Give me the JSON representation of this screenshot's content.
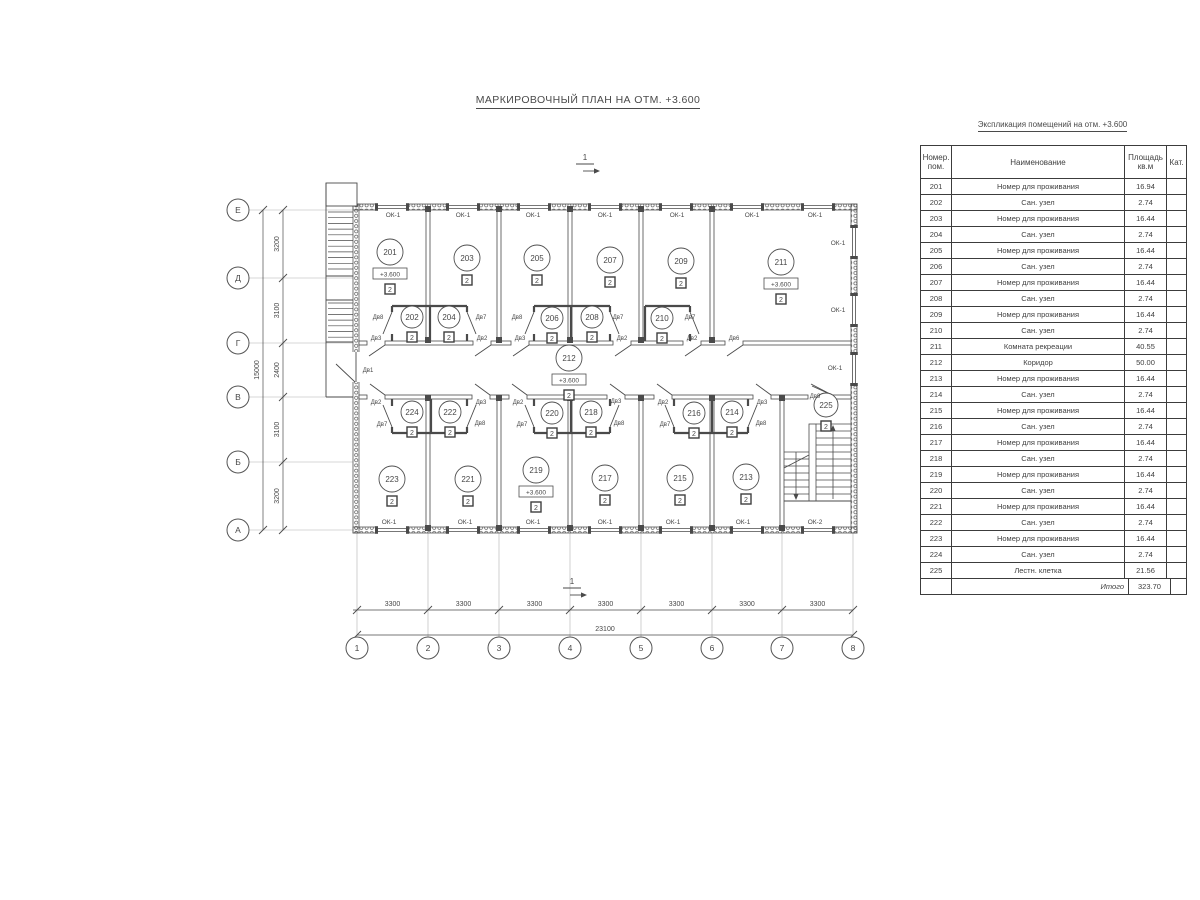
{
  "page_title": "МАРКИРОВОЧНЫЙ ПЛАН НА ОТМ. +3.600",
  "schedule": {
    "title": "Экспликация помещений на отм. +3.600",
    "headers": {
      "num": "Номер.\nпом.",
      "name": "Наименование",
      "area": "Площадь\nкв.м",
      "cat": "Кат."
    },
    "rows": [
      {
        "num": "201",
        "name": "Номер для проживания",
        "area": "16.94"
      },
      {
        "num": "202",
        "name": "Сан. узел",
        "area": "2.74"
      },
      {
        "num": "203",
        "name": "Номер для проживания",
        "area": "16.44"
      },
      {
        "num": "204",
        "name": "Сан. узел",
        "area": "2.74"
      },
      {
        "num": "205",
        "name": "Номер для проживания",
        "area": "16.44"
      },
      {
        "num": "206",
        "name": "Сан. узел",
        "area": "2.74"
      },
      {
        "num": "207",
        "name": "Номер для проживания",
        "area": "16.44"
      },
      {
        "num": "208",
        "name": "Сан. узел",
        "area": "2.74"
      },
      {
        "num": "209",
        "name": "Номер для проживания",
        "area": "16.44"
      },
      {
        "num": "210",
        "name": "Сан. узел",
        "area": "2.74"
      },
      {
        "num": "211",
        "name": "Комната рекреации",
        "area": "40.55"
      },
      {
        "num": "212",
        "name": "Коридор",
        "area": "50.00"
      },
      {
        "num": "213",
        "name": "Номер для проживания",
        "area": "16.44"
      },
      {
        "num": "214",
        "name": "Сан. узел",
        "area": "2.74"
      },
      {
        "num": "215",
        "name": "Номер для проживания",
        "area": "16.44"
      },
      {
        "num": "216",
        "name": "Сан. узел",
        "area": "2.74"
      },
      {
        "num": "217",
        "name": "Номер для проживания",
        "area": "16.44"
      },
      {
        "num": "218",
        "name": "Сан. узел",
        "area": "2.74"
      },
      {
        "num": "219",
        "name": "Номер для проживания",
        "area": "16.44"
      },
      {
        "num": "220",
        "name": "Сан. узел",
        "area": "2.74"
      },
      {
        "num": "221",
        "name": "Номер для проживания",
        "area": "16.44"
      },
      {
        "num": "222",
        "name": "Сан. узел",
        "area": "2.74"
      },
      {
        "num": "223",
        "name": "Номер для проживания",
        "area": "16.44"
      },
      {
        "num": "224",
        "name": "Сан. узел",
        "area": "2.74"
      },
      {
        "num": "225",
        "name": "Лестн. клетка",
        "area": "21.56"
      }
    ],
    "total_label": "Итого",
    "total_area": "323.70"
  },
  "plan": {
    "grid_cols": [
      {
        "label": "1",
        "x": 357
      },
      {
        "label": "2",
        "x": 428
      },
      {
        "label": "3",
        "x": 499
      },
      {
        "label": "4",
        "x": 570
      },
      {
        "label": "5",
        "x": 641
      },
      {
        "label": "6",
        "x": 712
      },
      {
        "label": "7",
        "x": 782
      },
      {
        "label": "8",
        "x": 853
      }
    ],
    "grid_rows": [
      {
        "label": "Е",
        "y": 210
      },
      {
        "label": "Д",
        "y": 278
      },
      {
        "label": "Г",
        "y": 343
      },
      {
        "label": "В",
        "y": 397
      },
      {
        "label": "Б",
        "y": 462
      },
      {
        "label": "А",
        "y": 530
      }
    ],
    "left_dims": {
      "segments": [
        "3200",
        "3100",
        "2400",
        "3100",
        "3200"
      ],
      "total": "15000"
    },
    "bottom_dims": {
      "segments": [
        "3300",
        "3300",
        "3300",
        "3300",
        "3300",
        "3300",
        "3300"
      ],
      "total": "23100"
    },
    "section_marks": [
      {
        "text": "1",
        "x": 585,
        "y": 160
      },
      {
        "text": "1",
        "x": 572,
        "y": 584
      }
    ],
    "level_mark": "+3.600",
    "category_mark": "2",
    "rooms": [
      {
        "id": "201",
        "x": 390,
        "y": 252,
        "r": 13,
        "level": true
      },
      {
        "id": "203",
        "x": 467,
        "y": 258,
        "r": 13
      },
      {
        "id": "205",
        "x": 537,
        "y": 258,
        "r": 13
      },
      {
        "id": "207",
        "x": 610,
        "y": 260,
        "r": 13
      },
      {
        "id": "209",
        "x": 681,
        "y": 261,
        "r": 13
      },
      {
        "id": "211",
        "x": 781,
        "y": 262,
        "r": 13,
        "level": true
      },
      {
        "id": "202",
        "x": 412,
        "y": 317,
        "r": 11
      },
      {
        "id": "204",
        "x": 449,
        "y": 317,
        "r": 11
      },
      {
        "id": "206",
        "x": 552,
        "y": 318,
        "r": 11
      },
      {
        "id": "208",
        "x": 592,
        "y": 317,
        "r": 11
      },
      {
        "id": "210",
        "x": 662,
        "y": 318,
        "r": 11
      },
      {
        "id": "212",
        "x": 569,
        "y": 358,
        "r": 13,
        "level": true
      },
      {
        "id": "224",
        "x": 412,
        "y": 412,
        "r": 11
      },
      {
        "id": "222",
        "x": 450,
        "y": 412,
        "r": 11
      },
      {
        "id": "220",
        "x": 552,
        "y": 413,
        "r": 11
      },
      {
        "id": "218",
        "x": 591,
        "y": 412,
        "r": 11
      },
      {
        "id": "216",
        "x": 694,
        "y": 413,
        "r": 11
      },
      {
        "id": "214",
        "x": 732,
        "y": 412,
        "r": 11
      },
      {
        "id": "223",
        "x": 392,
        "y": 479,
        "r": 13
      },
      {
        "id": "221",
        "x": 468,
        "y": 479,
        "r": 13
      },
      {
        "id": "219",
        "x": 536,
        "y": 470,
        "r": 13,
        "level": true
      },
      {
        "id": "217",
        "x": 605,
        "y": 478,
        "r": 13
      },
      {
        "id": "215",
        "x": 680,
        "y": 478,
        "r": 13
      },
      {
        "id": "213",
        "x": 746,
        "y": 477,
        "r": 13
      },
      {
        "id": "225",
        "x": 826,
        "y": 405,
        "r": 12
      }
    ],
    "window_labels": [
      {
        "text": "ОК-1",
        "x": 393,
        "y": 217
      },
      {
        "text": "ОК-1",
        "x": 463,
        "y": 217
      },
      {
        "text": "ОК-1",
        "x": 533,
        "y": 217
      },
      {
        "text": "ОК-1",
        "x": 605,
        "y": 217
      },
      {
        "text": "ОК-1",
        "x": 677,
        "y": 217
      },
      {
        "text": "ОК-1",
        "x": 752,
        "y": 217
      },
      {
        "text": "ОК-1",
        "x": 815,
        "y": 217
      },
      {
        "text": "ОК-1",
        "x": 389,
        "y": 524
      },
      {
        "text": "ОК-1",
        "x": 465,
        "y": 524
      },
      {
        "text": "ОК-1",
        "x": 533,
        "y": 524
      },
      {
        "text": "ОК-1",
        "x": 605,
        "y": 524
      },
      {
        "text": "ОК-1",
        "x": 673,
        "y": 524
      },
      {
        "text": "ОК-1",
        "x": 743,
        "y": 524
      },
      {
        "text": "ОК-2",
        "x": 815,
        "y": 524
      },
      {
        "text": "ОК-1",
        "x": 838,
        "y": 245
      },
      {
        "text": "ОК-1",
        "x": 838,
        "y": 312
      },
      {
        "text": "ОК-1",
        "x": 835,
        "y": 370
      }
    ],
    "door_labels": [
      {
        "text": "Дв8",
        "x": 378,
        "y": 319
      },
      {
        "text": "Дв7",
        "x": 481,
        "y": 319
      },
      {
        "text": "Дв8",
        "x": 517,
        "y": 319
      },
      {
        "text": "Дв7",
        "x": 618,
        "y": 319
      },
      {
        "text": "Дв7",
        "x": 690,
        "y": 319
      },
      {
        "text": "Дв3",
        "x": 376,
        "y": 340
      },
      {
        "text": "Дв2",
        "x": 482,
        "y": 340
      },
      {
        "text": "Дв3",
        "x": 520,
        "y": 340
      },
      {
        "text": "Дв2",
        "x": 622,
        "y": 340
      },
      {
        "text": "Дв2",
        "x": 692,
        "y": 340
      },
      {
        "text": "Дв6",
        "x": 734,
        "y": 340
      },
      {
        "text": "Дв1",
        "x": 368,
        "y": 372
      },
      {
        "text": "Дв2",
        "x": 376,
        "y": 404
      },
      {
        "text": "Дв3",
        "x": 481,
        "y": 404
      },
      {
        "text": "Дв2",
        "x": 518,
        "y": 404
      },
      {
        "text": "Дв3",
        "x": 616,
        "y": 403
      },
      {
        "text": "Дв2",
        "x": 663,
        "y": 404
      },
      {
        "text": "Дв3",
        "x": 762,
        "y": 404
      },
      {
        "text": "Дв9",
        "x": 815,
        "y": 398
      },
      {
        "text": "Дв7",
        "x": 382,
        "y": 426
      },
      {
        "text": "Дв8",
        "x": 480,
        "y": 425
      },
      {
        "text": "Дв7",
        "x": 522,
        "y": 426
      },
      {
        "text": "Дв8",
        "x": 619,
        "y": 425
      },
      {
        "text": "Дв7",
        "x": 665,
        "y": 426
      },
      {
        "text": "Дв8",
        "x": 761,
        "y": 425
      }
    ]
  }
}
